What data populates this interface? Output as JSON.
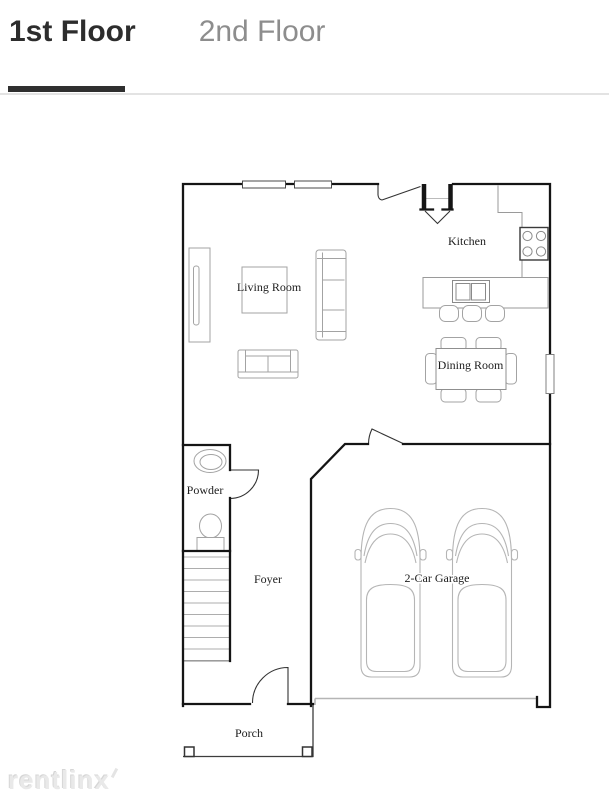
{
  "header": {
    "tabs": [
      {
        "label": "1st Floor",
        "active": true
      },
      {
        "label": "2nd Floor",
        "active": false
      }
    ]
  },
  "floorplan": {
    "rooms": {
      "living_room": "Living Room",
      "kitchen": "Kitchen",
      "dining_room": "Dining Room",
      "powder": "Powder",
      "foyer": "Foyer",
      "garage": "2-Car Garage",
      "porch": "Porch"
    }
  },
  "watermark": {
    "text": "rentlinx"
  },
  "colors": {
    "tab_active": "#2d2d2d",
    "tab_inactive": "#8d8d8d",
    "wall": "#151515",
    "furniture_line": "#a3a3a3",
    "divider": "#e3e3e3",
    "watermark": "#e9e9e9"
  }
}
